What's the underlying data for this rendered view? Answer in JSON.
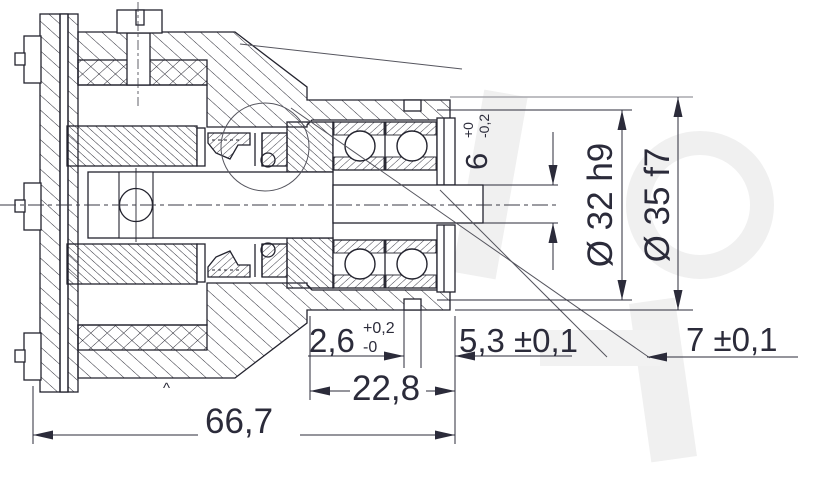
{
  "drawing": {
    "title": "spindle-bearing-assembly-cross-section",
    "line_color": "#23232e",
    "dim_color": "#2b2b3a",
    "gray_line_color": "#a8a8ae",
    "watermark_color": "#f0f0f0",
    "dimensions": {
      "slot_width": {
        "value": "6",
        "tol_upper": "+0",
        "tol_lower": "-0,2"
      },
      "dia_inner": {
        "value": "Ø 32 h9"
      },
      "dia_outer": {
        "value": "Ø 35 f7"
      },
      "groove_width": {
        "value": "2,6",
        "tol_upper": "+0,2",
        "tol_lower": "-0"
      },
      "groove_to_face": {
        "value": "5,3 ±0,1"
      },
      "stub_length": {
        "value": "7 ±0,1"
      },
      "bearing_section_length": {
        "value": "22,8"
      },
      "overall_length": {
        "value": "66,7"
      },
      "caret_mark": "^"
    }
  }
}
